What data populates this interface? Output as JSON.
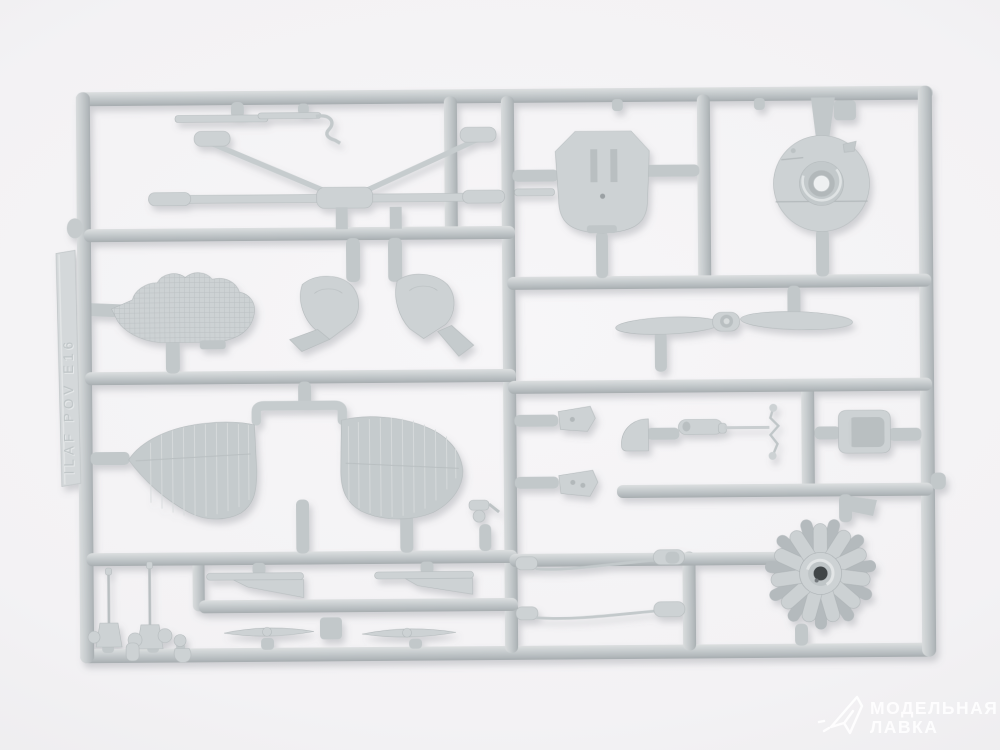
{
  "watermark": {
    "line1": "МОДЕЛЬНАЯ",
    "line2": "ЛАВКА"
  },
  "sprue": {
    "embossed_text": "ILAF POV E16",
    "parts": [
      "thin-strip-small",
      "thin-strip-hook",
      "cabane-strut-assembly",
      "cockpit-bulkhead",
      "cowling-front-disc",
      "two-blade-propeller",
      "radiator-panel",
      "cowling-side-left",
      "cowling-side-right",
      "wing-center-section",
      "lower-wing-left",
      "lower-wing-right",
      "cockpit-wedge-upper",
      "cockpit-wedge-lower",
      "headrest-half-disc",
      "tank-cylinder",
      "control-wire-zigzag",
      "pilot-seat",
      "radial-engine",
      "rigging-rod-upper",
      "rigging-rod-lower",
      "machine-gun-left",
      "machine-gun-right",
      "tail-fin-left",
      "tail-fin-right",
      "stabilizer-blade-left",
      "stabilizer-blade-right",
      "small-fittings"
    ]
  },
  "palette": {
    "background": "#f3f2f4",
    "plastic": "#cdd2d4",
    "plastic_light": "#dde1e2",
    "plastic_shadow": "#a8aeb1",
    "gate": "#c2c8ca",
    "tab": "#d4d8da",
    "watermark_white": "#ffffff"
  }
}
